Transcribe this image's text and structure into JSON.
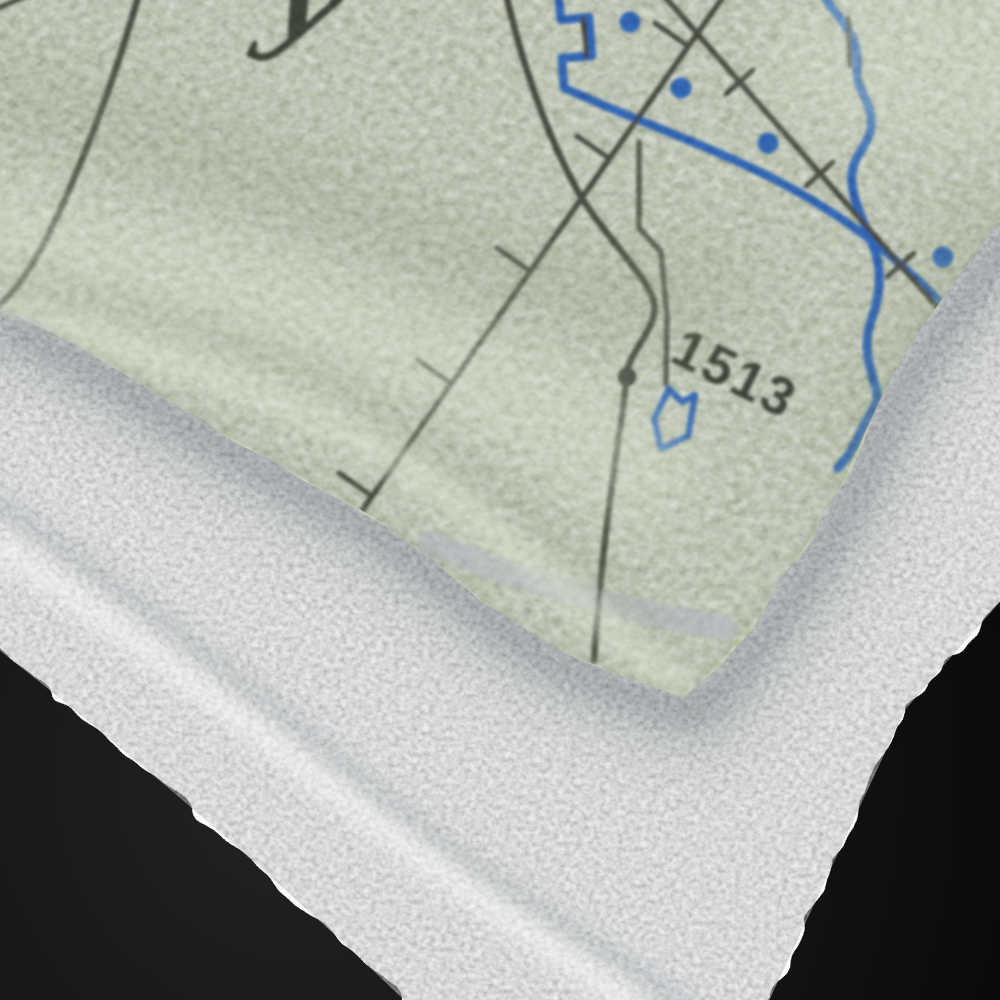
{
  "scene": {
    "type": "product-photo",
    "subject": "Folded fleece blanket printed with a sectional map design, lying on a folded white terry towel against a black background",
    "map_print": {
      "spot_elevation_label": "1513",
      "partial_place_text": "y",
      "features": [
        "curved roads",
        "railroad with tick marks",
        "blue canal with dot markers",
        "blue winding stream",
        "small pond outline",
        "spot elevation dot",
        "wide gray road band"
      ]
    },
    "colors": {
      "background": "#0c0c0c",
      "background_glow": "#262626",
      "towel_white": "#f6f7f8",
      "towel_crease": "#8f979c",
      "cast_shadow": "#4a5257",
      "stitch_thread": "#c9cdd1",
      "fabric_green": "#b2bf9f",
      "fabric_green_light": "#d9e0c7",
      "fabric_green_dark": "#7f8e72",
      "map_line_dark": "#3c4037",
      "map_blue": "#2b56a1",
      "map_gray_road": "#a9acaf",
      "map_label_dark": "#363a30"
    }
  }
}
